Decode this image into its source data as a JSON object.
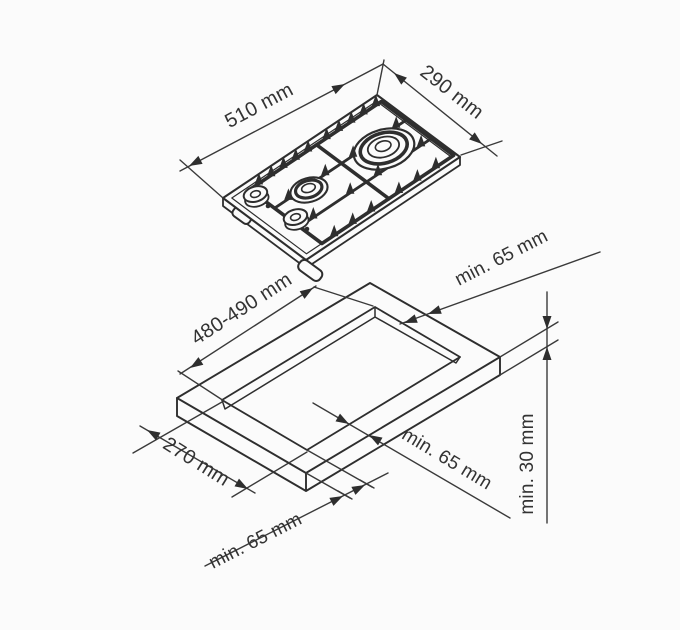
{
  "canvas": {
    "background": "#fbfbfb",
    "line_color": "#2e2e2e",
    "text_color": "#333333"
  },
  "hob_view": {
    "width_label": "510 mm",
    "depth_label": "290 mm"
  },
  "worktop_view": {
    "cutout_length_label": "480-490 mm",
    "cutout_width_label": "270 mm",
    "rear_clearance_label": "min. 65 mm",
    "side_clearance_label": "min. 65 mm",
    "front_clearance_label": "min. 65 mm",
    "thickness_label": "min. 30 mm"
  }
}
